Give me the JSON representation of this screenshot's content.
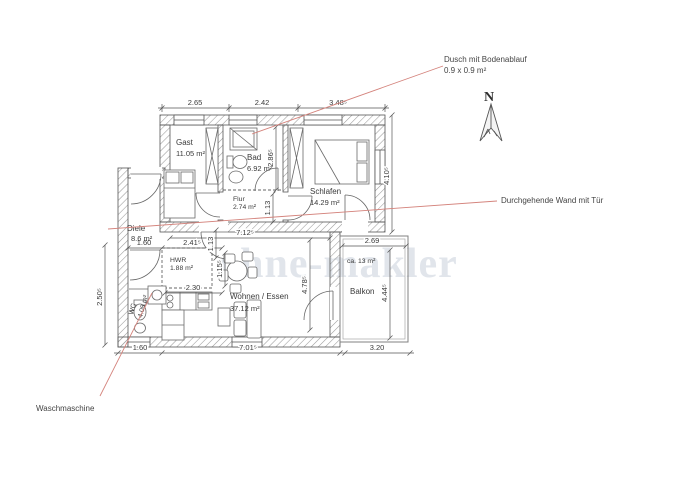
{
  "watermark": "ohne-makler",
  "compass": {
    "label": "N"
  },
  "annotations": {
    "shower_line1": "Dusch mit Bodenablauf",
    "shower_line2": "0.9 x 0.9 m²",
    "continuous_wall": "Durchgehende Wand mit Tür",
    "washing_machine": "Waschmaschine"
  },
  "rooms": {
    "gast": {
      "name": "Gast",
      "area": "11.05 m²"
    },
    "bad": {
      "name": "Bad",
      "area": "6.92 m²"
    },
    "schlafen": {
      "name": "Schlafen",
      "area": "14.29 m²"
    },
    "flur": {
      "name": "Flur",
      "area": "2.74 m²"
    },
    "diele": {
      "name": "Diele",
      "area": "8.6 m²"
    },
    "hwr": {
      "name": "HWR",
      "area": "1.88 m²"
    },
    "wc": {
      "name": "WC",
      "area": "4.08 m²"
    },
    "wohnen_essen": {
      "name": "Wohnen / Essen",
      "area": "37.12 m²"
    },
    "balkon": {
      "name": "Balkon",
      "area": "ca. 13 m²"
    }
  },
  "dimensions": {
    "top": [
      "2.65",
      "2.42",
      "3.48⁵"
    ],
    "right_side": "4.10⁵",
    "bottom": [
      "1.60",
      "7.01⁵",
      "3.20"
    ],
    "left_side": "2.50⁵",
    "inner_width": "7.12⁵",
    "diele_width": "1.60",
    "hwr_width": "2.41⁵",
    "kitchen_width": "2.30",
    "balcony_width": "2.69",
    "balcony_height": "4.44⁵",
    "living_height": "4.78⁵",
    "flur_height": "1.13",
    "hwr_height": "1.13",
    "kitchen_height": "1.15⁵",
    "bad_height": "2.86⁵"
  },
  "colors": {
    "plan_line": "#4a4a4a",
    "hatch": "#909090",
    "leader_line": "#d4837c",
    "watermark": "#c9d0dc",
    "text": "#3a3a3a"
  }
}
